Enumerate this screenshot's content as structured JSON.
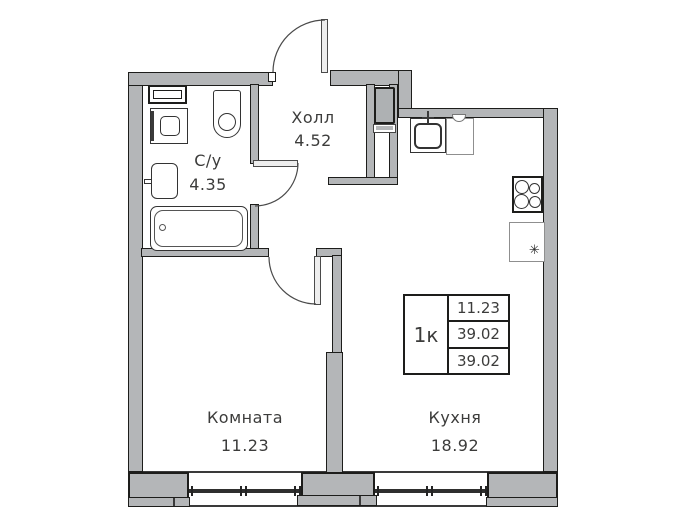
{
  "floorplan": {
    "rooms": [
      {
        "name": "Холл",
        "area": "4.52"
      },
      {
        "name": "С/у",
        "area": "4.35"
      },
      {
        "name": "Комната",
        "area": "11.23"
      },
      {
        "name": "Кухня",
        "area": "18.92"
      }
    ],
    "info_table": {
      "type": "1к",
      "rows": [
        "11.23",
        "39.02",
        "39.02"
      ]
    },
    "icons": {
      "fridge_snowflake": "✳"
    },
    "colors": {
      "wall": "#b4b6b8",
      "outline": "#1d1d1b",
      "text": "#3c3c3b",
      "window_line": "#2f2f2e"
    }
  }
}
